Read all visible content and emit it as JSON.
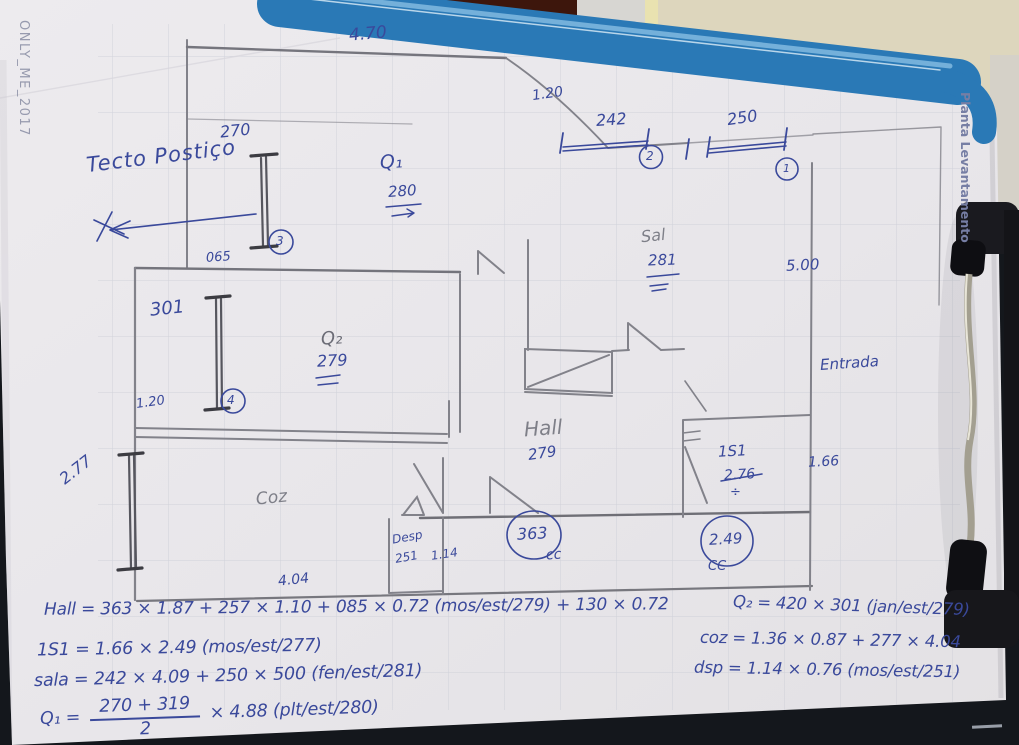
{
  "photo": {
    "watermark": "ONLY_ME_2017",
    "side_label": "Planta Levantamento",
    "note_top_left": "Tecto Postiço"
  },
  "plan": {
    "rooms": {
      "hall": "Hall",
      "sala": "Sal",
      "kitchen": "Coz",
      "pantry": "Desp",
      "bedroom1": "Q₁",
      "bedroom2": "Q₂",
      "bathroom": "1S1",
      "entrance": "Entrada"
    },
    "dimensions": {
      "top_width": "4.70",
      "top_offset": "1.20",
      "window2_width": "242",
      "window1_width": "250",
      "window3_height": "270",
      "wall_offset": "065",
      "bedroom1_height": "280",
      "sala_height": "281",
      "sala_depth": "5.00",
      "window4_height": "301",
      "bedroom2_height": "279",
      "left_offset": "1.20",
      "window5_height": "2.77",
      "hall_height": "279",
      "bathroom_old": "2.76",
      "division_sign": "÷",
      "entrance_width": "1.66",
      "pantry_width": "251",
      "pantry_depth": "1.14",
      "kitchen_width": "4.04",
      "hall_length": "363",
      "bathroom_length": "2.49"
    },
    "markers": {
      "m1": "1",
      "m2": "2",
      "m3": "3",
      "m4": "4",
      "cc_hall": "cc",
      "cc_bath": "CC"
    }
  },
  "formulas": {
    "hall": "Hall = 363 × 1.87 + 257 × 1.10 + 085 × 0.72 (mos/est/279) + 130 × 0.72",
    "bathroom": "1S1 = 1.66 × 2.49 (mos/est/277)",
    "sala": "sala = 242 × 4.09 + 250 × 500 (fen/est/281)",
    "q1_lhs": "Q₁ =",
    "q1_numerator": "270 + 319",
    "q1_denominator": "2",
    "q1_rhs": "× 4.88 (plt/est/280)",
    "q2": "Q₂ = 420 × 301 (jan/est/279)",
    "kitchen": "coz = 1.36 × 0.87 + 277 × 4.04",
    "pantry": "dsp = 1.14 × 0.76 (mos/est/251)"
  }
}
